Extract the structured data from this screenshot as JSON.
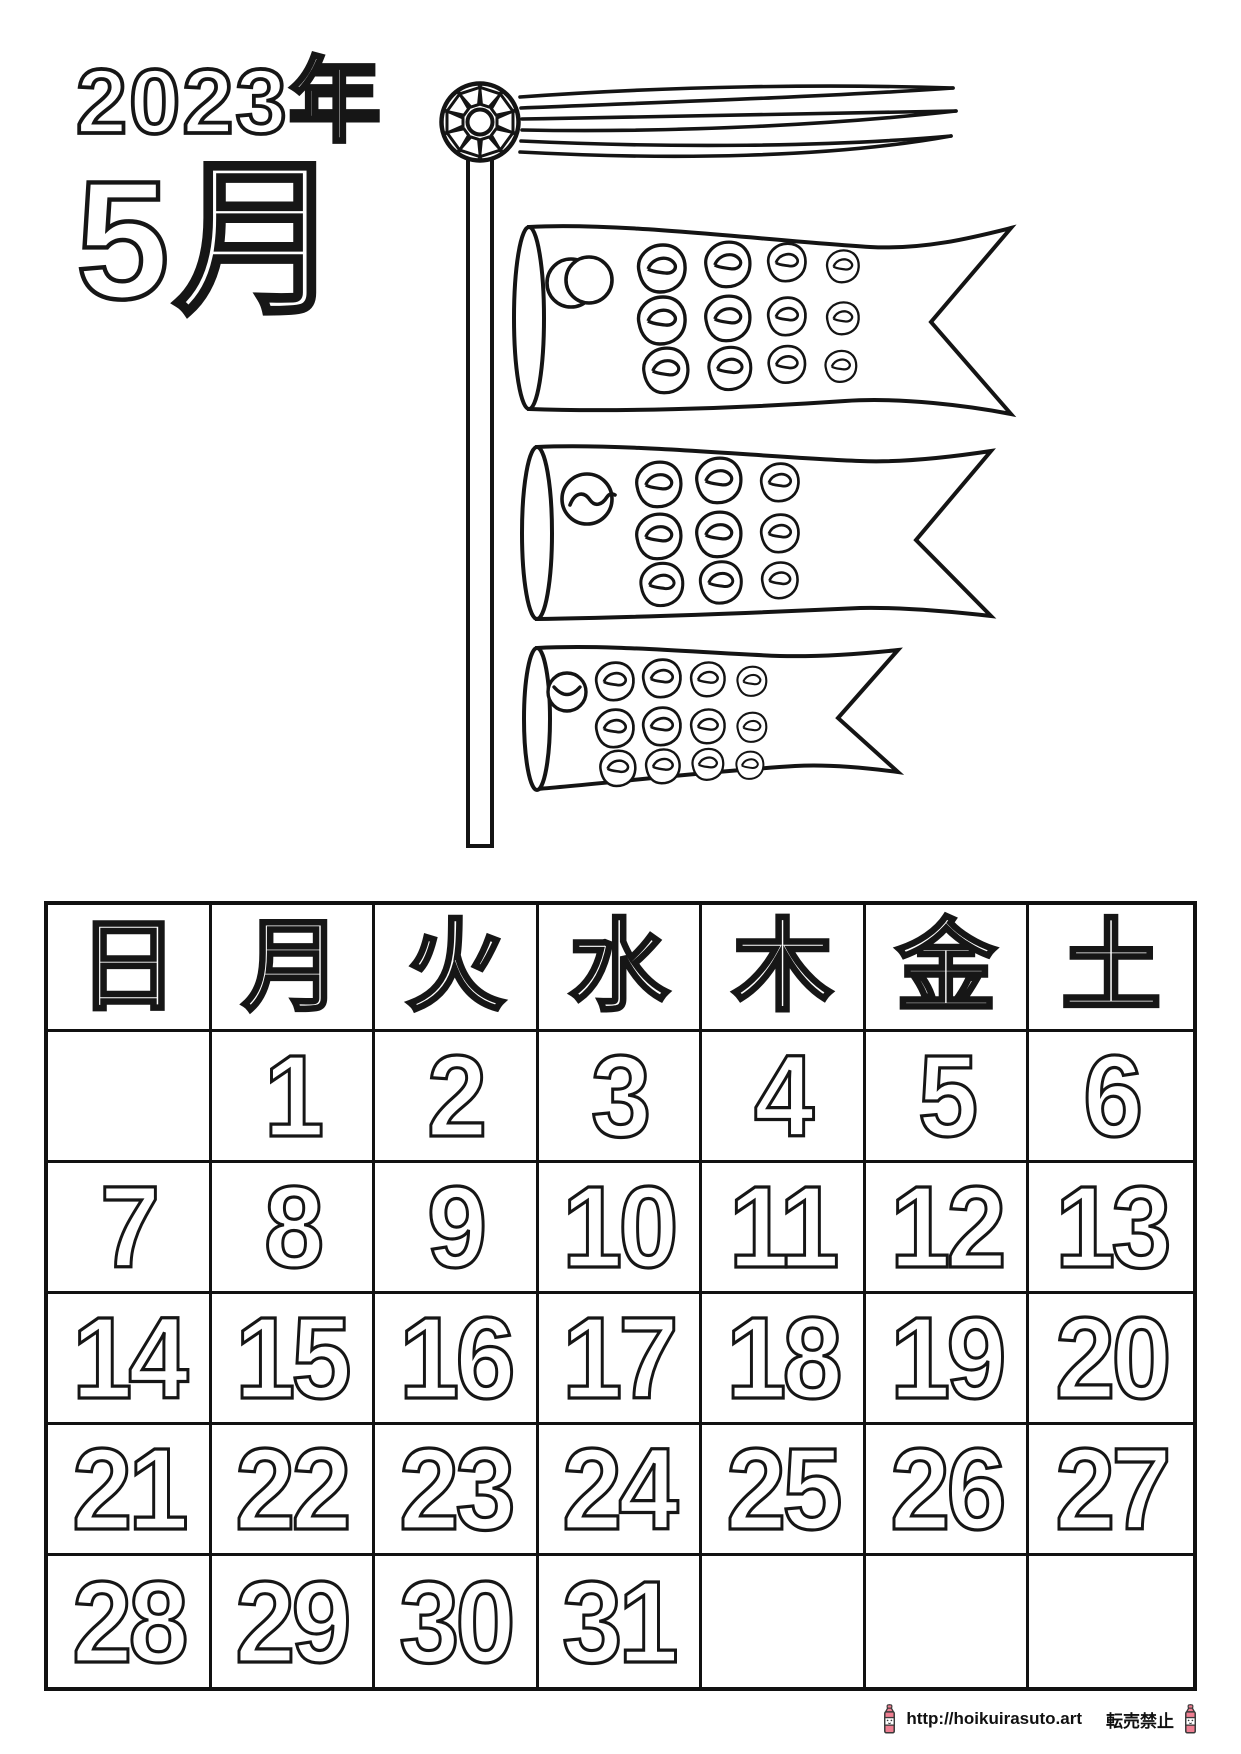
{
  "page": {
    "background": "#ffffff",
    "title_year": "2023年",
    "title_month": "5月"
  },
  "illustration": {
    "type": "koinobori-carp-streamers-coloring-outline",
    "carp_count": 3,
    "outline_color": "#161616",
    "fill_color": "#ffffff"
  },
  "calendar": {
    "border_color": "#111111",
    "weekday_headers": [
      "日",
      "月",
      "火",
      "水",
      "木",
      "金",
      "土"
    ],
    "weeks": [
      [
        "",
        "1",
        "2",
        "3",
        "4",
        "5",
        "6"
      ],
      [
        "7",
        "8",
        "9",
        "10",
        "11",
        "12",
        "13"
      ],
      [
        "14",
        "15",
        "16",
        "17",
        "18",
        "19",
        "20"
      ],
      [
        "21",
        "22",
        "23",
        "24",
        "25",
        "26",
        "27"
      ],
      [
        "28",
        "29",
        "30",
        "31",
        "",
        "",
        ""
      ]
    ]
  },
  "footer": {
    "url": "http://hoikuirasuto.art",
    "notice": "転売禁止",
    "crayon_color": "#ee7e91"
  }
}
